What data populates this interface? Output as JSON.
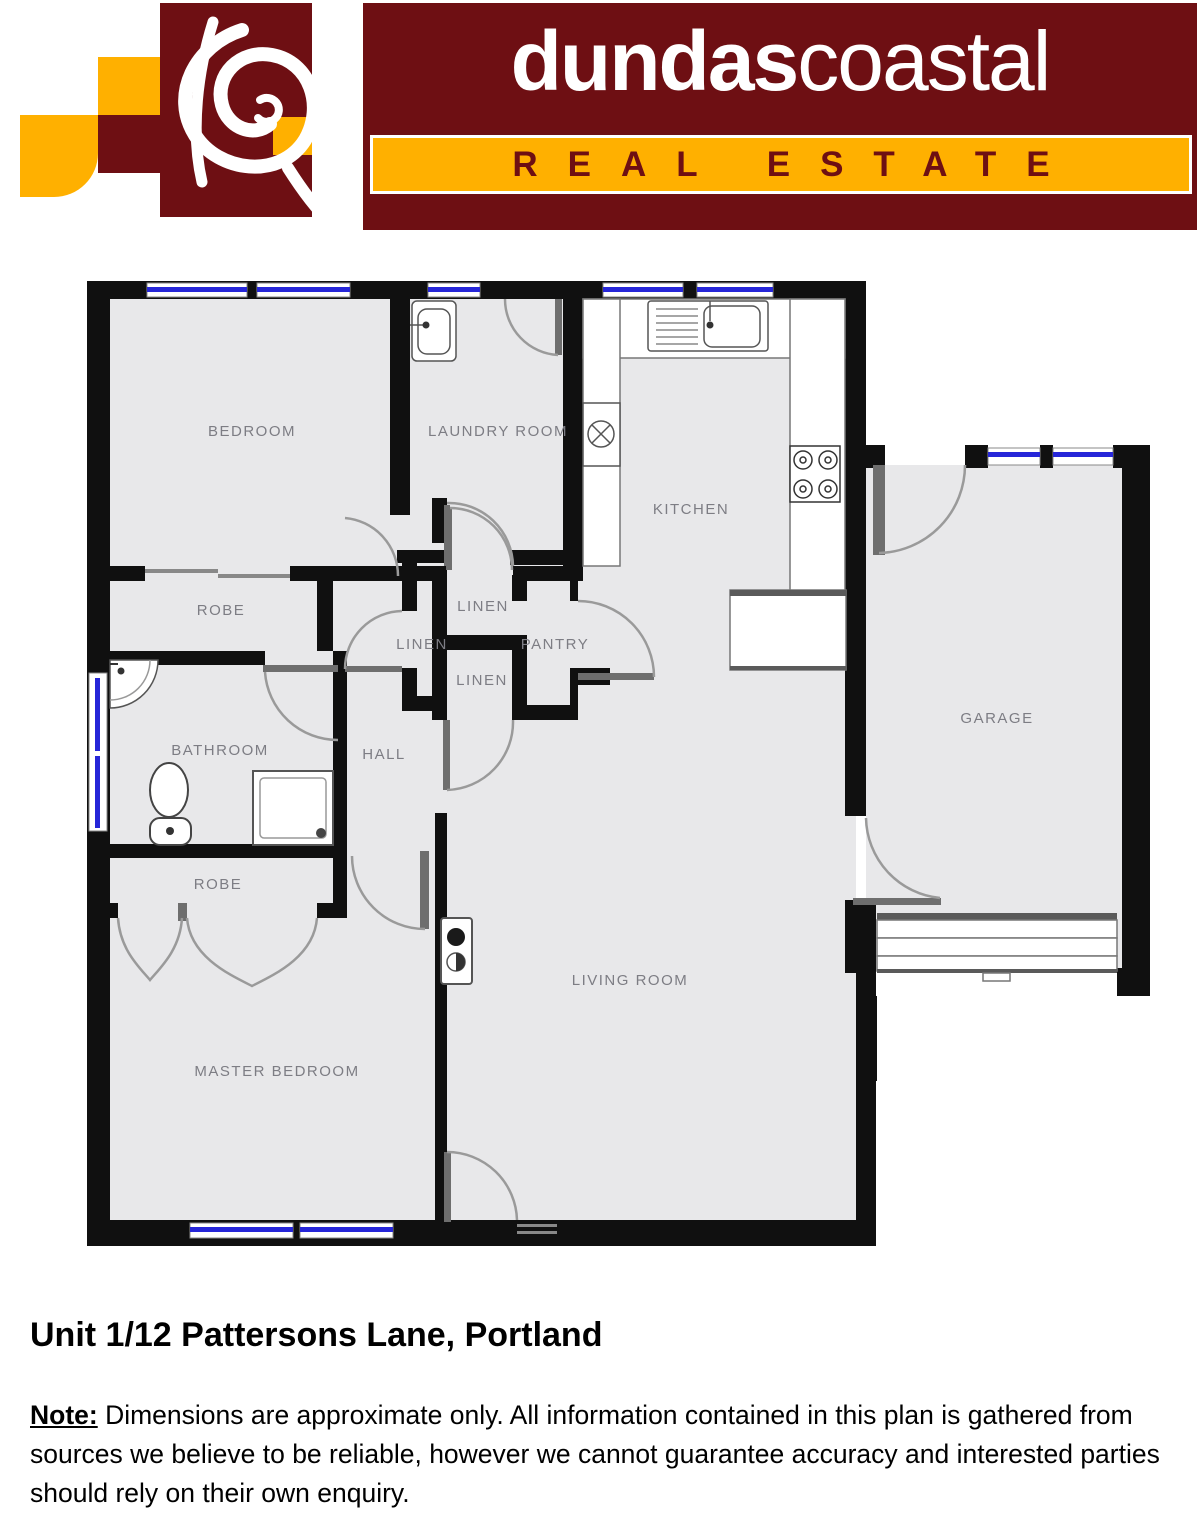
{
  "brand": {
    "name_bold": "dundas",
    "name_light": "coastal",
    "tagline": "REAL ESTATE"
  },
  "colors": {
    "maroon": "#6e0f13",
    "gold": "#ffb000",
    "wall": "#101010",
    "floor": "#e8e8ea",
    "window_blue": "#2626d8",
    "door_arc": "#9a9a9a",
    "label_gray": "#7d7d84"
  },
  "floorplan": {
    "rooms": {
      "bedroom": "BEDROOM",
      "laundry": "LAUNDRY ROOM",
      "kitchen": "KITCHEN",
      "garage": "GARAGE",
      "robe_top": "ROBE",
      "linen_top": "LINEN",
      "linen_left": "LINEN",
      "pantry": "PANTRY",
      "linen_bottom": "LINEN",
      "bathroom": "BATHROOM",
      "hall": "HALL",
      "robe_master": "ROBE",
      "living": "LIVING ROOM",
      "master": "MASTER BEDROOM"
    }
  },
  "footer": {
    "title": "Unit 1/12 Pattersons Lane, Portland",
    "note_label": "Note:",
    "note_body": " Dimensions are approximate only. All information contained in this plan is gathered from sources we believe to be reliable, however we  cannot guarantee  accuracy and interested parties should rely on their own enquiry."
  }
}
